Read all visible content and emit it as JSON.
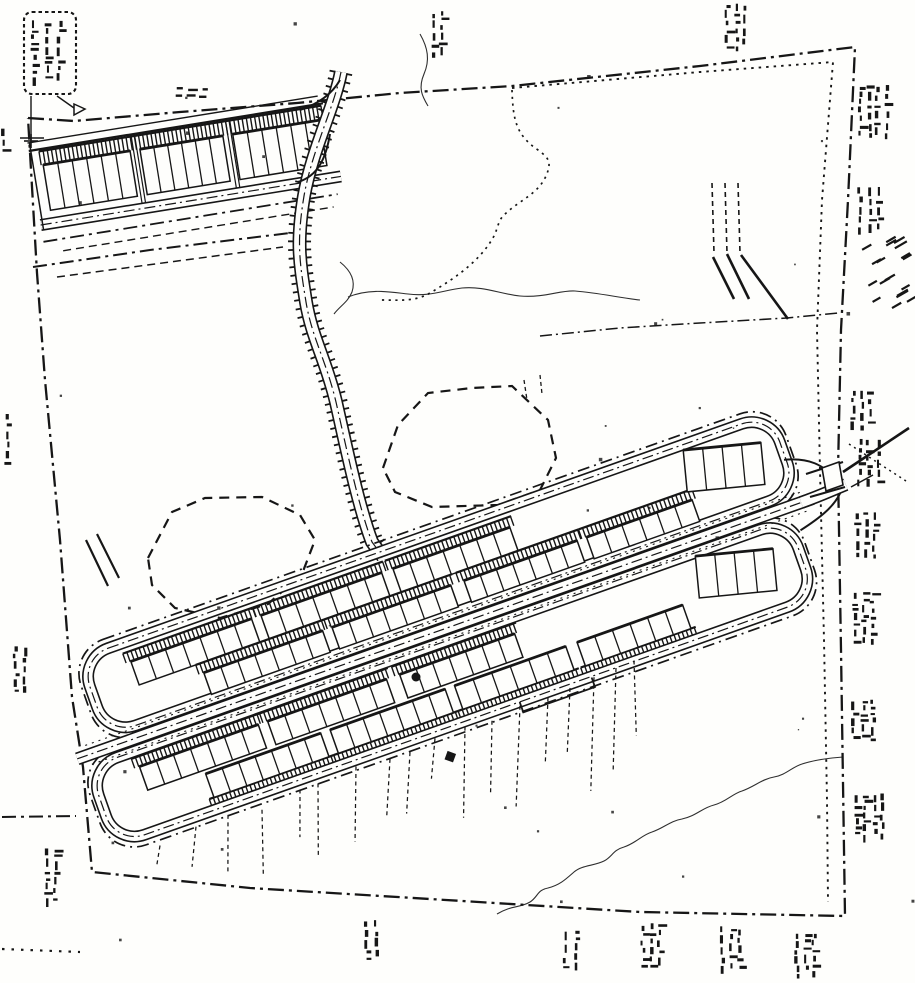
{
  "canvas": {
    "width": 915,
    "height": 983
  },
  "palette": {
    "paper": "#fefefc",
    "ink": "#161616",
    "ink_soft": "#2e2e2e"
  },
  "drawing": {
    "boundary": {
      "outer": [
        [
          28,
          118
        ],
        [
          74,
          121
        ],
        [
          180,
          112
        ],
        [
          297,
          103
        ],
        [
          400,
          93
        ],
        [
          512,
          86
        ],
        [
          700,
          66
        ],
        [
          855,
          47
        ],
        [
          848,
          200
        ],
        [
          841,
          330
        ],
        [
          838,
          470
        ],
        [
          841,
          650
        ],
        [
          845,
          916
        ],
        [
          640,
          912
        ],
        [
          430,
          899
        ],
        [
          250,
          888
        ],
        [
          92,
          872
        ],
        [
          83,
          767
        ],
        [
          72,
          697
        ],
        [
          60,
          540
        ],
        [
          45,
          380
        ],
        [
          37,
          273
        ],
        [
          28,
          118
        ]
      ],
      "inner_dotted": [
        [
          512,
          88
        ],
        [
          700,
          72
        ],
        [
          833,
          62
        ],
        [
          822,
          200
        ],
        [
          817,
          330
        ],
        [
          820,
          470
        ],
        [
          824,
          640
        ],
        [
          827,
          800
        ],
        [
          828,
          902
        ]
      ],
      "south_parcel_dashdot": [
        [
          33,
          267
        ],
        [
          150,
          250
        ],
        [
          290,
          233
        ]
      ],
      "south_parcel_dashed": [
        [
          57,
          277
        ],
        [
          170,
          262
        ],
        [
          283,
          247
        ]
      ],
      "left_exit_dashdot": [
        [
          2,
          817
        ],
        [
          76,
          816
        ]
      ],
      "bottom_left_dotted": [
        [
          2,
          949
        ],
        [
          80,
          952
        ]
      ]
    },
    "upper_development": {
      "origin": [
        35,
        152
      ],
      "angle": -9.2,
      "extent_x": [
        -6,
        292
      ],
      "ticks": {
        "y": [
          0,
          14
        ],
        "x": [
          4,
          290
        ],
        "step": 4.2
      },
      "building_y": [
        14,
        60
      ],
      "clusters": [
        {
          "x": 6,
          "w": 88,
          "units": 6
        },
        {
          "x": 104,
          "w": 84,
          "units": 6
        },
        {
          "x": 198,
          "w": 88,
          "units": 6
        }
      ],
      "gap_lines_x": [
        97.5,
        101,
        193,
        196.5
      ],
      "bottom_street_y": 73,
      "dashdot_y": 90,
      "dashed_y": 102
    },
    "access_road": {
      "path": "M 341,72 C 334,108 312,150 304,196 C 296,244 300,264 306,302 C 312,338 326,360 336,402 C 346,446 358,505 372,542 L 383,557",
      "connectors": [
        "M 300,110 C 318,104 332,94 340,80",
        "M 298,182 C 318,176 326,158 330,134"
      ]
    },
    "lower_development": {
      "origin": [
        95,
        725
      ],
      "angle": -19.5,
      "north_strip": {
        "loop": [
          8,
          -68,
          740,
          14
        ],
        "outer": [
          0,
          -78,
          748,
          24
        ],
        "rows": [
          {
            "tick": [
              -58,
              -48
            ],
            "bldg": [
              -48,
              -23
            ],
            "clusters": [
              {
                "x": 55,
                "w": 128,
                "units": 7
              },
              {
                "x": 193,
                "w": 128,
                "units": 7
              },
              {
                "x": 333,
                "w": 124,
                "units": 7
              }
            ]
          },
          {
            "tick": [
              -23,
              -13
            ],
            "bldg": [
              -13,
              10
            ],
            "clusters": [
              {
                "x": 120,
                "w": 126,
                "units": 7
              },
              {
                "x": 256,
                "w": 126,
                "units": 7
              },
              {
                "x": 396,
                "w": 120,
                "units": 7
              },
              {
                "x": 526,
                "w": 112,
                "units": 6
              }
            ]
          }
        ],
        "end_block": {
          "x": 640,
          "y": -54,
          "w": 78,
          "h": 42,
          "units": 4,
          "rot": 14
        }
      },
      "south_strip": {
        "loop": [
          -20,
          38,
          722,
          120
        ],
        "outer": [
          -28,
          28,
          730,
          130
        ],
        "rows": [
          {
            "tick": [
              44,
              54
            ],
            "bldg": [
              54,
              79
            ],
            "clusters": [
              {
                "x": 28,
                "w": 126,
                "units": 7
              },
              {
                "x": 164,
                "w": 126,
                "units": 7
              },
              {
                "x": 304,
                "w": 122,
                "units": 7
              }
            ]
          },
          {
            "tick": [
              108,
              115
            ],
            "bldg": [
              83,
              108
            ],
            "tick_below": true,
            "clusters": [
              {
                "x": 88,
                "w": 122,
                "units": 7
              },
              {
                "x": 220,
                "w": 122,
                "units": 7
              },
              {
                "x": 352,
                "w": 118,
                "units": 6
              },
              {
                "x": 482,
                "w": 112,
                "units": 6
              }
            ]
          }
        ],
        "end_block": {
          "x": 616,
          "y": 50,
          "w": 78,
          "h": 42,
          "units": 4,
          "rot": 14
        }
      },
      "spine": {
        "road": "M -28,26 L 752,26",
        "dotted_y": [
          16,
          36
        ],
        "dotted_x": [
          -16,
          744
        ]
      },
      "entrance_path": "M 740,26 C 760,26 768,25 788,24",
      "loop_connectors": [
        "M 738,-20 C 762,-14 774,-2 780,16",
        "M 730,52 C 756,46 770,40 780,30"
      ],
      "bump": "M 408,120 L 408,131 L 484,131 L 484,121"
    },
    "entrance": {
      "flare": [
        [
          806,
          474,
          843,
          462
        ],
        [
          810,
          497,
          845,
          487
        ]
      ],
      "island": [
        [
          822,
          468
        ],
        [
          839,
          462
        ],
        [
          843,
          485
        ],
        [
          826,
          491
        ]
      ],
      "exit_line": [
        843,
        472,
        909,
        428
      ],
      "stub": [
        851,
        487,
        873,
        475
      ],
      "dotted_diag": [
        849,
        444,
        906,
        481
      ]
    },
    "wetlands": [
      [
        [
          383,
          468
        ],
        [
          398,
          425
        ],
        [
          428,
          393
        ],
        [
          472,
          388
        ],
        [
          512,
          386
        ],
        [
          548,
          420
        ],
        [
          556,
          458
        ],
        [
          540,
          490
        ],
        [
          498,
          505
        ],
        [
          432,
          507
        ],
        [
          395,
          492
        ]
      ],
      [
        [
          148,
          558
        ],
        [
          172,
          512
        ],
        [
          205,
          498
        ],
        [
          262,
          497
        ],
        [
          300,
          515
        ],
        [
          315,
          540
        ],
        [
          302,
          574
        ],
        [
          268,
          604
        ],
        [
          220,
          618
        ],
        [
          175,
          608
        ],
        [
          152,
          585
        ]
      ]
    ],
    "contours": {
      "solid": [
        "M 348,297 C 370,288 390,292 408,294 C 430,297 444,290 462,288 C 484,286 500,294 520,296 C 545,298 560,290 575,291 C 600,293 620,298 640,300",
        "M 340,262 C 350,270 356,280 352,292 C 348,302 340,306 334,314",
        "M 420,34 C 428,48 430,60 424,74 C 418,88 422,96 428,106",
        "M 497,914 C 512,905 520,908 530,902 C 538,897 537,890 548,888 C 560,885 566,879 574,872 C 582,865 594,866 604,861 C 612,857 613,850 624,847 C 636,843 642,835 652,832 C 664,828 670,821 682,819 C 696,816 702,808 714,805 C 726,802 732,794 742,791 C 754,787 762,779 774,777 C 786,775 792,767 802,764 C 814,760 824,759 832,758 L 843,757"
      ],
      "dashdot": [
        "M 540,336 L 620,328 L 700,323 L 787,318 L 838,313"
      ],
      "dotted": [
        "M 512,90 C 513,120 516,135 538,150 C 549,158 552,162 546,176 C 538,194 520,200 505,214 C 498,220 498,228 494,236 C 480,262 452,280 430,293 C 415,302 398,300 380,300"
      ]
    },
    "hatch_marks": {
      "slope_lines": [
        [
          713,
          257,
          734,
          299
        ],
        [
          727,
          254,
          749,
          299
        ],
        [
          741,
          255,
          788,
          319
        ]
      ],
      "left_diagonals": [
        [
          86,
          540,
          108,
          586
        ],
        [
          97,
          534,
          119,
          578
        ]
      ],
      "top_drop_ticks": [
        [
          524,
          380,
          527,
          400
        ],
        [
          540,
          375,
          542,
          394
        ]
      ],
      "vertical_dotted_right": {
        "x": 712,
        "y": 183,
        "h": 70,
        "n": 3,
        "gap": 13
      }
    },
    "callout": {
      "box": [
        24,
        12,
        52,
        82
      ],
      "leader_down": [
        31,
        96,
        31,
        140
      ],
      "leader_diag": [
        57,
        96,
        74,
        108
      ],
      "cross": [
        31,
        141
      ],
      "arrow": [
        [
          74,
          104
        ],
        [
          85,
          109
        ],
        [
          74,
          115
        ]
      ],
      "tie_line": [
        20,
        138,
        44,
        138
      ],
      "columns": [
        [
          30,
          20,
          10,
          64
        ],
        [
          43,
          20,
          10,
          64
        ],
        [
          55,
          20,
          9,
          64
        ]
      ]
    },
    "dots": {
      "circle": [
        416,
        677,
        4.5
      ],
      "square": [
        446,
        752,
        9
      ]
    },
    "drop_lines": {
      "xs": [
        160,
        196,
        228,
        262,
        300,
        318,
        356,
        390,
        410,
        435,
        465,
        492,
        520,
        548,
        570,
        594,
        616,
        634
      ],
      "edge": [
        115,
        862,
        -0.3807
      ],
      "bottom": [
        92,
        872,
        0.0748
      ]
    },
    "noise_clusters": [
      [
        428,
        10,
        26,
        50,
        "v"
      ],
      [
        722,
        2,
        30,
        48,
        "v"
      ],
      [
        855,
        85,
        40,
        52,
        "v"
      ],
      [
        856,
        185,
        30,
        46,
        "v"
      ],
      [
        858,
        240,
        46,
        26,
        "d"
      ],
      [
        862,
        276,
        46,
        32,
        "d"
      ],
      [
        848,
        390,
        28,
        40,
        "v"
      ],
      [
        856,
        438,
        30,
        46,
        "v"
      ],
      [
        852,
        512,
        34,
        50,
        "v"
      ],
      [
        850,
        592,
        32,
        54,
        "v"
      ],
      [
        850,
        698,
        30,
        44,
        "v"
      ],
      [
        852,
        792,
        36,
        48,
        "v"
      ],
      [
        638,
        922,
        32,
        50,
        "v"
      ],
      [
        718,
        926,
        28,
        46,
        "v"
      ],
      [
        792,
        933,
        30,
        44,
        "v"
      ],
      [
        362,
        920,
        24,
        42,
        "v"
      ],
      [
        562,
        930,
        26,
        42,
        "v"
      ],
      [
        42,
        848,
        22,
        54,
        "v"
      ],
      [
        12,
        646,
        26,
        50,
        "v"
      ],
      [
        2,
        413,
        14,
        52,
        "v"
      ],
      [
        0,
        126,
        12,
        28,
        "v"
      ],
      [
        174,
        86,
        38,
        18,
        "h"
      ]
    ],
    "speckles": {
      "count": 40,
      "seed": 13
    }
  }
}
